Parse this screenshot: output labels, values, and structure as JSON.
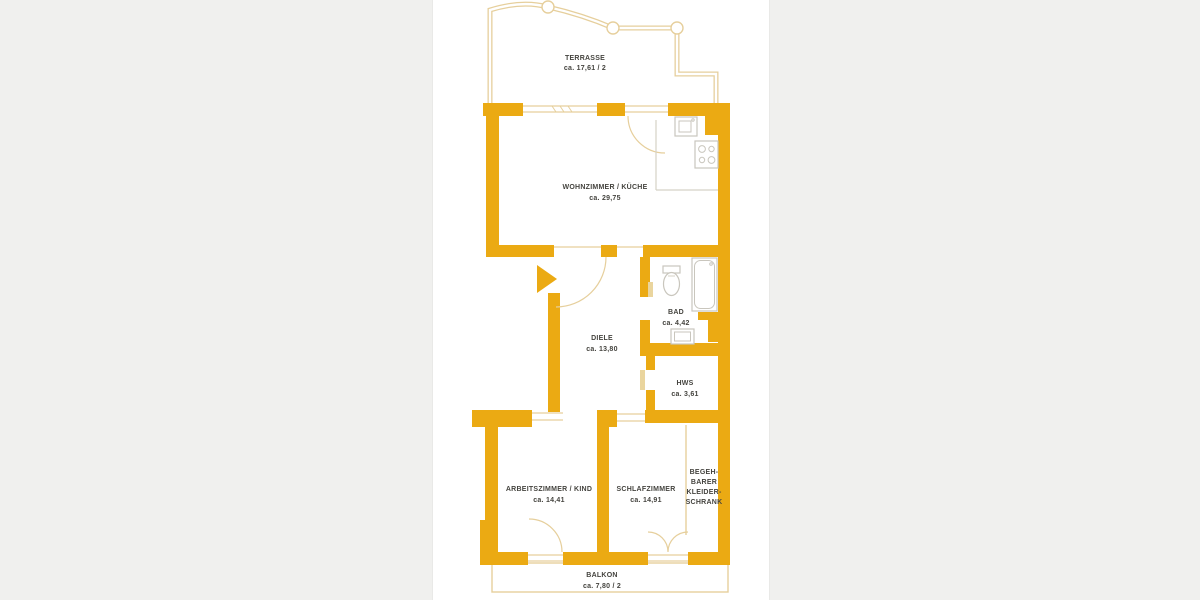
{
  "plan": {
    "colors": {
      "wall": "#ebaa13",
      "thin_outline": "#e6cf9c",
      "door_leaf": "#ead59e",
      "fixture_stroke": "#c9c6bd",
      "label_text": "#45443f",
      "canvas": "#ffffff",
      "margin": "#f0f0ee"
    },
    "rooms": {
      "terrasse": {
        "name": "TERRASSE",
        "area": "ca. 17,61 / 2"
      },
      "wohnzimmer": {
        "name": "WOHNZIMMER / KÜCHE",
        "area": "ca. 29,75"
      },
      "bad": {
        "name": "BAD",
        "area": "ca. 4,42"
      },
      "diele": {
        "name": "DIELE",
        "area": "ca. 13,80"
      },
      "hws": {
        "name": "HWS",
        "area": "ca. 3,61"
      },
      "arbeitszimmer": {
        "name": "ARBEITSZIMMER / KIND",
        "area": "ca. 14,41"
      },
      "schlafzimmer": {
        "name": "SCHLAFZIMMER",
        "area": "ca. 14,91"
      },
      "kleiderschrank": {
        "lines": [
          "BEGEH-",
          "BARER",
          "KLEIDER-",
          "SCHRANK"
        ]
      },
      "balkon": {
        "name": "BALKON",
        "area": "ca. 7,80 / 2"
      }
    }
  }
}
